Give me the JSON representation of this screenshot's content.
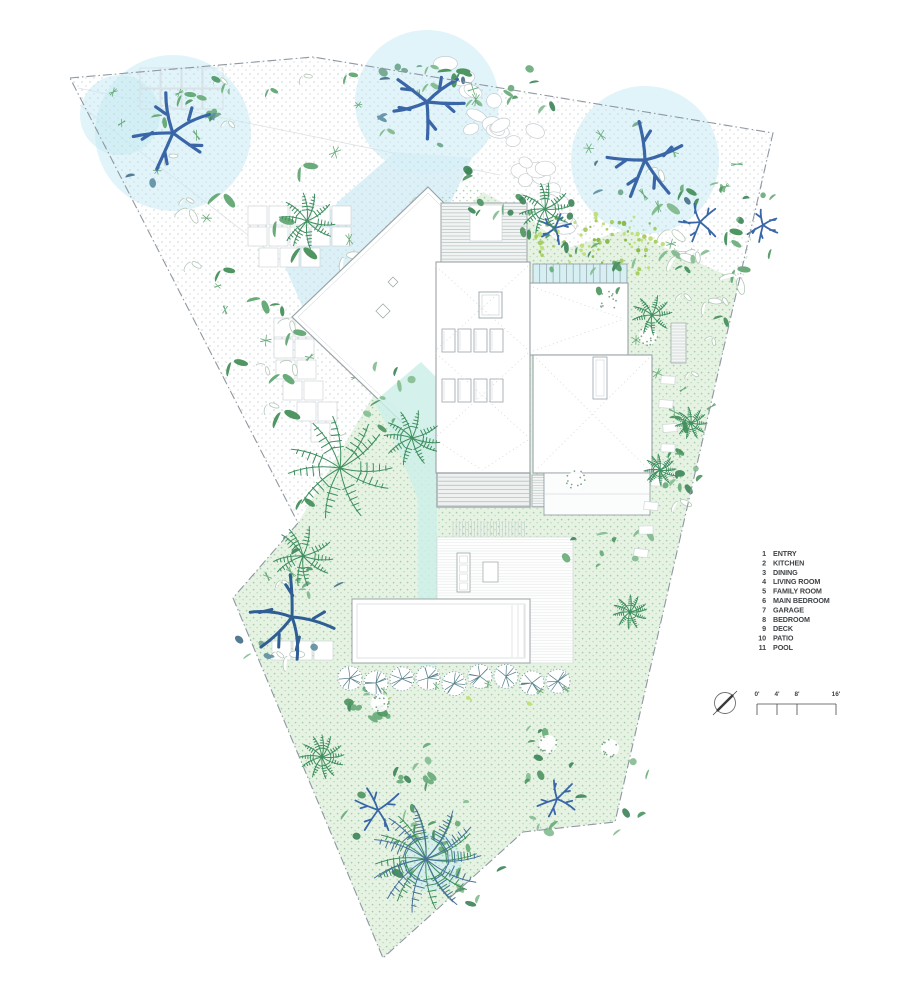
{
  "legend": {
    "items": [
      {
        "num": "1",
        "label": "ENTRY"
      },
      {
        "num": "2",
        "label": "KITCHEN"
      },
      {
        "num": "3",
        "label": "DINING"
      },
      {
        "num": "4",
        "label": "LIVING ROOM"
      },
      {
        "num": "5",
        "label": "FAMILY ROOM"
      },
      {
        "num": "6",
        "label": "MAIN BEDROOM"
      },
      {
        "num": "7",
        "label": "GARAGE"
      },
      {
        "num": "8",
        "label": "BEDROOM"
      },
      {
        "num": "9",
        "label": "DECK"
      },
      {
        "num": "10",
        "label": "PATIO"
      },
      {
        "num": "11",
        "label": "POOL"
      }
    ]
  },
  "scale_bar": {
    "ticks": [
      "0'",
      "4'",
      "8'",
      "16'"
    ]
  },
  "colors": {
    "lawn": "#e6f3e3",
    "lawn_dot": "#a6cead",
    "white_dot": "#c9d1d6",
    "cyan": "#d7f0f6",
    "teal": "#cdeee7",
    "halo": "#c7ebf4",
    "wall": "#9aa3a8",
    "wall_dark": "#8b9499",
    "line_light": "#c6cdd1",
    "deck_line": "#b7c2c3",
    "boundary": "#8f98a2",
    "greens": [
      "#4f9663",
      "#69ab79",
      "#86bd92",
      "#3f855a"
    ],
    "blue_leaf": [
      "#46708a",
      "#5f8fa3",
      "#6da58b"
    ],
    "trunk": "#3a66a8",
    "trunk_dark": "#2f5590",
    "palm": "#3f8f5f",
    "palm_dark": "#48719b",
    "speckle": [
      "#a7cf63",
      "#c0e07e",
      "#8bbb4f"
    ],
    "fern": "#567f8b",
    "outline_plant": "#b5c8b8",
    "text": "#3f4347"
  },
  "plan": {
    "site": [
      [
        70,
        78
      ],
      [
        313,
        57
      ],
      [
        773,
        133
      ],
      [
        615,
        822
      ],
      [
        523,
        832
      ],
      [
        383,
        958
      ],
      [
        233,
        598
      ],
      [
        298,
        523
      ]
    ],
    "white_region": [
      [
        70,
        78
      ],
      [
        313,
        57
      ],
      [
        773,
        133
      ],
      [
        742,
        282
      ],
      [
        625,
        230
      ],
      [
        568,
        248
      ],
      [
        520,
        212
      ],
      [
        470,
        185
      ],
      [
        432,
        196
      ],
      [
        405,
        300
      ],
      [
        372,
        398
      ],
      [
        298,
        523
      ]
    ],
    "drive_wedge": [
      [
        78,
        88
      ],
      [
        500,
        175
      ],
      [
        470,
        205
      ],
      [
        320,
        330
      ],
      [
        280,
        262
      ],
      [
        80,
        105
      ]
    ],
    "drive_cyan": [
      [
        395,
        152
      ],
      [
        472,
        158
      ],
      [
        447,
        210
      ],
      [
        316,
        338
      ],
      [
        283,
        262
      ],
      [
        340,
        200
      ]
    ],
    "walk_cyan": [
      [
        374,
        402
      ],
      [
        421,
        362
      ],
      [
        437,
        378
      ],
      [
        437,
        665
      ],
      [
        418,
        665
      ],
      [
        418,
        500
      ],
      [
        395,
        440
      ]
    ],
    "halos": [
      [
        173,
        133,
        78
      ],
      [
        427,
        102,
        72
      ],
      [
        645,
        160,
        74
      ],
      [
        120,
        115,
        40
      ],
      [
        432,
        862,
        30
      ]
    ],
    "cobble_region": {
      "x0": 468,
      "y0": 88,
      "x1": 560,
      "y1": 212,
      "n": 26
    },
    "pavers19": [
      [
        248,
        206
      ],
      [
        269,
        206
      ],
      [
        290,
        206
      ],
      [
        311,
        206
      ],
      [
        332,
        206
      ],
      [
        248,
        227
      ],
      [
        269,
        227
      ],
      [
        290,
        227
      ],
      [
        311,
        227
      ],
      [
        332,
        227
      ],
      [
        259,
        248
      ],
      [
        280,
        248
      ],
      [
        301,
        248
      ],
      [
        274,
        318
      ],
      [
        295,
        318
      ],
      [
        274,
        339
      ],
      [
        295,
        339
      ],
      [
        276,
        360
      ],
      [
        297,
        360
      ],
      [
        283,
        381
      ],
      [
        304,
        381
      ],
      [
        297,
        402
      ],
      [
        318,
        402
      ],
      [
        311,
        423
      ],
      [
        272,
        641
      ],
      [
        293,
        641
      ],
      [
        314,
        641
      ]
    ],
    "pavers_outline": [
      [
        140,
        68
      ],
      [
        161,
        68
      ],
      [
        182,
        68
      ],
      [
        203,
        68
      ],
      [
        140,
        89
      ],
      [
        161,
        89
      ],
      [
        182,
        89
      ],
      [
        203,
        89
      ]
    ],
    "house": {
      "diamond": [
        [
          428,
          187
        ],
        [
          558,
          317
        ],
        [
          428,
          447
        ],
        [
          292,
          317
        ]
      ],
      "diamond_inset": [
        [
          428,
          193
        ],
        [
          552,
          317
        ],
        [
          428,
          441
        ],
        [
          298,
          317
        ]
      ],
      "diamond_skylights": [
        [
          393,
          282,
          7
        ],
        [
          383,
          311,
          10
        ]
      ],
      "deck_top": [
        441,
        203,
        86,
        59
      ],
      "spa": [
        470,
        205,
        32,
        36
      ],
      "roof_main": [
        436,
        262,
        94,
        211
      ],
      "pergola": [
        533,
        264,
        94,
        19
      ],
      "wing_upper": [
        530,
        283,
        98,
        72
      ],
      "wing_lower": [
        533,
        355,
        119,
        118
      ],
      "slot": [
        593,
        357,
        14,
        42
      ],
      "skylight_big": [
        479,
        292,
        23,
        26
      ],
      "skylight_rows": [
        {
          "y": 329,
          "xs": [
            442,
            458,
            474,
            490
          ],
          "w": 13,
          "h": 23
        },
        {
          "y": 379,
          "xs": [
            442,
            458,
            474,
            490
          ],
          "w": 13,
          "h": 23
        }
      ],
      "deck_bottom": [
        437,
        473,
        93,
        34
      ],
      "stair_right": [
        532,
        475,
        12,
        32
      ],
      "block_br": [
        544,
        473,
        106,
        42
      ],
      "treads": [
        453,
        521,
        74,
        15
      ],
      "patio": [
        437,
        537,
        136,
        126
      ],
      "island": [
        457,
        553,
        13,
        39
      ],
      "table": [
        483,
        562,
        15,
        20
      ],
      "pool": [
        352,
        599,
        178,
        64
      ],
      "stair_tr": [
        671,
        323,
        15,
        40
      ]
    },
    "stones": [
      [
        668,
        380
      ],
      [
        666,
        404
      ],
      [
        670,
        428
      ],
      [
        668,
        448
      ],
      [
        663,
        466
      ],
      [
        658,
        482
      ],
      [
        651,
        506
      ],
      [
        646,
        530
      ],
      [
        641,
        553
      ]
    ],
    "trees": [
      {
        "x": 173,
        "y": 133,
        "r": 66,
        "type": "blue"
      },
      {
        "x": 427,
        "y": 102,
        "r": 60,
        "type": "blue"
      },
      {
        "x": 645,
        "y": 160,
        "r": 62,
        "type": "blue"
      },
      {
        "x": 292,
        "y": 617,
        "r": 74,
        "type": "bigGreen"
      },
      {
        "x": 555,
        "y": 228,
        "r": 34,
        "type": "ring"
      },
      {
        "x": 700,
        "y": 222,
        "r": 42,
        "type": "ring"
      },
      {
        "x": 763,
        "y": 225,
        "r": 34,
        "type": "ring"
      },
      {
        "x": 378,
        "y": 810,
        "r": 46,
        "type": "ringStar"
      },
      {
        "x": 557,
        "y": 799,
        "r": 40,
        "type": "ringStar"
      }
    ],
    "palms": [
      {
        "x": 340,
        "y": 468,
        "r": 52
      },
      {
        "x": 303,
        "y": 556,
        "r": 30
      },
      {
        "x": 307,
        "y": 221,
        "r": 28
      },
      {
        "x": 545,
        "y": 209,
        "r": 26
      },
      {
        "x": 412,
        "y": 438,
        "r": 28
      },
      {
        "x": 426,
        "y": 859,
        "r": 55,
        "dark": 1
      },
      {
        "x": 652,
        "y": 315,
        "r": 20
      },
      {
        "x": 660,
        "y": 470,
        "r": 16
      },
      {
        "x": 630,
        "y": 612,
        "r": 17
      },
      {
        "x": 691,
        "y": 423,
        "r": 16
      },
      {
        "x": 322,
        "y": 757,
        "r": 22
      }
    ],
    "clusters": [
      {
        "x": 490,
        "y": 195,
        "r": 40
      },
      {
        "x": 575,
        "y": 252,
        "r": 32
      },
      {
        "x": 625,
        "y": 285,
        "r": 28
      },
      {
        "x": 390,
        "y": 397,
        "r": 36
      },
      {
        "x": 598,
        "y": 560,
        "r": 38
      },
      {
        "x": 608,
        "y": 795,
        "r": 46
      },
      {
        "x": 420,
        "y": 762,
        "r": 33
      },
      {
        "x": 392,
        "y": 845,
        "r": 40
      },
      {
        "x": 478,
        "y": 880,
        "r": 32
      },
      {
        "x": 210,
        "y": 100,
        "r": 24
      },
      {
        "x": 535,
        "y": 90,
        "r": 28
      },
      {
        "x": 680,
        "y": 480,
        "r": 22
      },
      {
        "x": 545,
        "y": 742,
        "r": 26
      },
      {
        "x": 370,
        "y": 706,
        "r": 22
      },
      {
        "x": 455,
        "y": 828,
        "r": 30
      }
    ],
    "white_bushes": [
      [
        608,
        300
      ],
      [
        648,
        336
      ],
      [
        576,
        480
      ],
      [
        548,
        744
      ],
      [
        610,
        748
      ],
      [
        380,
        703
      ]
    ],
    "speckle_top": {
      "x": 600,
      "y": 245,
      "rx": 66,
      "ry": 36,
      "n": 80
    },
    "garden": {
      "x0": 345,
      "y0": 702,
      "x1": 640,
      "y1": 798,
      "rows": 8,
      "per_row": 15
    },
    "ferns": {
      "y": 680,
      "xs": [
        350,
        376,
        402,
        428,
        454,
        480,
        506,
        532,
        558
      ]
    },
    "scatter": [
      {
        "poly": [
          [
            92,
            88
          ],
          [
            305,
            66
          ],
          [
            425,
            180
          ],
          [
            398,
            335
          ],
          [
            300,
            505
          ],
          [
            205,
            330
          ]
        ],
        "n": 30,
        "sprigs": 14,
        "seed": 11
      },
      {
        "poly": [
          [
            330,
            62
          ],
          [
            490,
            62
          ],
          [
            490,
            150
          ],
          [
            360,
            150
          ]
        ],
        "n": 7,
        "sprigs": 4,
        "seed": 22
      },
      {
        "poly": [
          [
            565,
            120
          ],
          [
            755,
            140
          ],
          [
            740,
            295
          ],
          [
            618,
            232
          ]
        ],
        "n": 13,
        "sprigs": 8,
        "seed": 33
      },
      {
        "poly": [
          [
            622,
            242
          ],
          [
            742,
            292
          ],
          [
            676,
            585
          ],
          [
            628,
            562
          ]
        ],
        "n": 11,
        "sprigs": 6,
        "seed": 44
      },
      {
        "poly": [
          [
            242,
            560
          ],
          [
            296,
            532
          ],
          [
            344,
            630
          ],
          [
            262,
            672
          ]
        ],
        "n": 4,
        "sprigs": 2,
        "seed": 55
      }
    ],
    "roof_dotted": [
      [
        436,
        266,
        528,
        350
      ],
      [
        528,
        266,
        436,
        350
      ],
      [
        436,
        353,
        528,
        437
      ],
      [
        528,
        353,
        436,
        437
      ],
      [
        436,
        440,
        482,
        470
      ],
      [
        528,
        440,
        482,
        470
      ],
      [
        533,
        287,
        624,
        319
      ],
      [
        533,
        351,
        624,
        319
      ],
      [
        536,
        358,
        649,
        470
      ],
      [
        649,
        358,
        536,
        470
      ]
    ],
    "legend_pos": {
      "num_x": 766,
      "label_x": 773,
      "y0": 553,
      "dy": 9.4
    },
    "scale_pos": {
      "x0": 757,
      "x1": 836,
      "y_line": 704,
      "tick_xs": [
        757,
        777,
        797,
        836
      ],
      "y_text": 696,
      "tick_y1": 715,
      "circle": [
        725,
        703,
        10.5
      ]
    }
  }
}
